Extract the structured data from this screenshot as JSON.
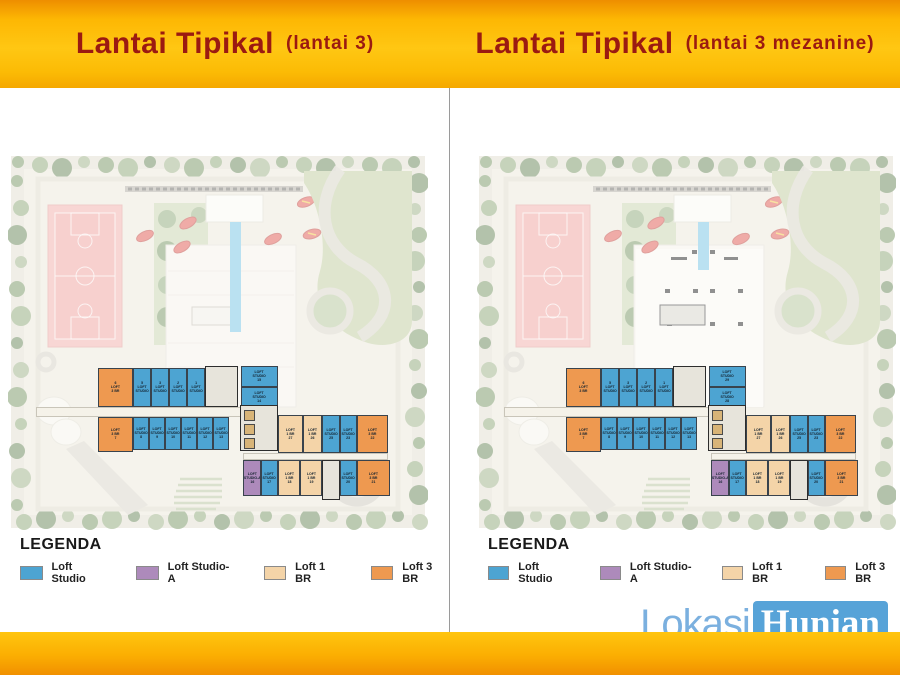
{
  "panels": [
    {
      "id": "lantai-3",
      "title": "Lantai Tipikal",
      "subtitle": "(lantai 3)",
      "mezzanine": false,
      "units": [
        {
          "t": "br3",
          "lines": [
            "6",
            "LOFT",
            "3 BR"
          ],
          "x": 90,
          "y": 215,
          "w": 35,
          "h": 39
        },
        {
          "t": "st",
          "lines": [
            "5",
            "LOFT",
            "STUDIO"
          ],
          "x": 125,
          "y": 215,
          "w": 18,
          "h": 39
        },
        {
          "t": "st",
          "lines": [
            "3",
            "LOFT",
            "STUDIO"
          ],
          "x": 143,
          "y": 215,
          "w": 18,
          "h": 39
        },
        {
          "t": "st",
          "lines": [
            "2",
            "LOFT",
            "STUDIO"
          ],
          "x": 161,
          "y": 215,
          "w": 18,
          "h": 39
        },
        {
          "t": "st",
          "lines": [
            "1",
            "LOFT",
            "STUDIO"
          ],
          "x": 179,
          "y": 215,
          "w": 18,
          "h": 39
        },
        {
          "t": "core",
          "sub": "stair",
          "x": 197,
          "y": 213,
          "w": 33,
          "h": 41
        },
        {
          "t": "st",
          "lines": [
            "LOFT",
            "STUDIO",
            "15"
          ],
          "x": 233,
          "y": 213,
          "w": 37,
          "h": 21
        },
        {
          "t": "st",
          "lines": [
            "LOFT",
            "STUDIO",
            "14"
          ],
          "x": 233,
          "y": 234,
          "w": 37,
          "h": 21
        },
        {
          "t": "cor",
          "x": 28,
          "y": 254,
          "w": 242,
          "h": 10
        },
        {
          "t": "br3",
          "lines": [
            "LOFT",
            "3 BR",
            "7"
          ],
          "x": 90,
          "y": 264,
          "w": 35,
          "h": 35
        },
        {
          "t": "st",
          "lines": [
            "LOFT",
            "STUDIO",
            "8"
          ],
          "x": 125,
          "y": 264,
          "w": 16,
          "h": 33
        },
        {
          "t": "st",
          "lines": [
            "LOFT",
            "STUDIO",
            "9"
          ],
          "x": 141,
          "y": 264,
          "w": 16,
          "h": 33
        },
        {
          "t": "st",
          "lines": [
            "LOFT",
            "STUDIO",
            "10"
          ],
          "x": 157,
          "y": 264,
          "w": 16,
          "h": 33
        },
        {
          "t": "st",
          "lines": [
            "LOFT",
            "STUDIO",
            "11"
          ],
          "x": 173,
          "y": 264,
          "w": 16,
          "h": 33
        },
        {
          "t": "st",
          "lines": [
            "LOFT",
            "STUDIO",
            "12"
          ],
          "x": 189,
          "y": 264,
          "w": 16,
          "h": 33
        },
        {
          "t": "st",
          "lines": [
            "LOFT",
            "STUDIO",
            "13"
          ],
          "x": 205,
          "y": 264,
          "w": 16,
          "h": 33
        },
        {
          "t": "core",
          "sub": "lift",
          "x": 232,
          "y": 252,
          "w": 38,
          "h": 46
        },
        {
          "t": "br1",
          "lines": [
            "LOFT",
            "1 BR",
            "27"
          ],
          "x": 270,
          "y": 262,
          "w": 25,
          "h": 38
        },
        {
          "t": "br1",
          "lines": [
            "LOFT",
            "1 BR",
            "26"
          ],
          "x": 295,
          "y": 262,
          "w": 19,
          "h": 38
        },
        {
          "t": "st",
          "lines": [
            "LOFT",
            "STUDIO",
            "25"
          ],
          "x": 314,
          "y": 262,
          "w": 18,
          "h": 38
        },
        {
          "t": "st",
          "lines": [
            "LOFT",
            "STUDIO",
            "23"
          ],
          "x": 332,
          "y": 262,
          "w": 17,
          "h": 38
        },
        {
          "t": "br3",
          "lines": [
            "LOFT",
            "3 BR",
            "22"
          ],
          "x": 349,
          "y": 262,
          "w": 31,
          "h": 38
        },
        {
          "t": "cor",
          "x": 235,
          "y": 300,
          "w": 145,
          "h": 7
        },
        {
          "t": "stA",
          "lines": [
            "LOFT",
            "STUDIO-A",
            "16"
          ],
          "x": 235,
          "y": 307,
          "w": 18,
          "h": 36
        },
        {
          "t": "st",
          "lines": [
            "LOFT",
            "STUDIO",
            "17"
          ],
          "x": 253,
          "y": 307,
          "w": 17,
          "h": 36
        },
        {
          "t": "br1",
          "lines": [
            "LOFT",
            "1 BR",
            "18"
          ],
          "x": 270,
          "y": 307,
          "w": 22,
          "h": 36
        },
        {
          "t": "br1",
          "lines": [
            "LOFT",
            "1 BR",
            "19"
          ],
          "x": 292,
          "y": 307,
          "w": 22,
          "h": 36
        },
        {
          "t": "core",
          "sub": "stair",
          "x": 314,
          "y": 307,
          "w": 18,
          "h": 40
        },
        {
          "t": "st",
          "lines": [
            "LOFT",
            "STUDIO",
            "20"
          ],
          "x": 332,
          "y": 307,
          "w": 17,
          "h": 36
        },
        {
          "t": "br3",
          "lines": [
            "LOFT",
            "3 BR",
            "21"
          ],
          "x": 349,
          "y": 307,
          "w": 33,
          "h": 36
        }
      ]
    },
    {
      "id": "lantai-3-mezanine",
      "title": "Lantai Tipikal",
      "subtitle": "(lantai 3 mezanine)",
      "mezzanine": true,
      "units": [
        {
          "t": "br3",
          "lines": [
            "6",
            "LOFT",
            "3 BR"
          ],
          "x": 90,
          "y": 215,
          "w": 35,
          "h": 39
        },
        {
          "t": "st",
          "lines": [
            "5",
            "LOFT",
            "STUDIO"
          ],
          "x": 125,
          "y": 215,
          "w": 18,
          "h": 39
        },
        {
          "t": "st",
          "lines": [
            "3",
            "LOFT",
            "STUDIO"
          ],
          "x": 143,
          "y": 215,
          "w": 18,
          "h": 39
        },
        {
          "t": "st",
          "lines": [
            "2",
            "LOFT",
            "STUDIO"
          ],
          "x": 161,
          "y": 215,
          "w": 18,
          "h": 39
        },
        {
          "t": "st",
          "lines": [
            "1",
            "LOFT",
            "STUDIO"
          ],
          "x": 179,
          "y": 215,
          "w": 18,
          "h": 39
        },
        {
          "t": "core",
          "sub": "stair",
          "x": 197,
          "y": 213,
          "w": 33,
          "h": 41
        },
        {
          "t": "st",
          "lines": [
            "LOFT",
            "STUDIO",
            "29"
          ],
          "x": 233,
          "y": 213,
          "w": 37,
          "h": 21
        },
        {
          "t": "st",
          "lines": [
            "LOFT",
            "STUDIO",
            "28"
          ],
          "x": 233,
          "y": 234,
          "w": 37,
          "h": 21
        },
        {
          "t": "cor",
          "x": 28,
          "y": 254,
          "w": 242,
          "h": 10
        },
        {
          "t": "br3",
          "lines": [
            "LOFT",
            "3 BR",
            "7"
          ],
          "x": 90,
          "y": 264,
          "w": 35,
          "h": 35
        },
        {
          "t": "st",
          "lines": [
            "LOFT",
            "STUDIO",
            "8"
          ],
          "x": 125,
          "y": 264,
          "w": 16,
          "h": 33
        },
        {
          "t": "st",
          "lines": [
            "LOFT",
            "STUDIO",
            "9"
          ],
          "x": 141,
          "y": 264,
          "w": 16,
          "h": 33
        },
        {
          "t": "st",
          "lines": [
            "LOFT",
            "STUDIO",
            "10"
          ],
          "x": 157,
          "y": 264,
          "w": 16,
          "h": 33
        },
        {
          "t": "st",
          "lines": [
            "LOFT",
            "STUDIO",
            "11"
          ],
          "x": 173,
          "y": 264,
          "w": 16,
          "h": 33
        },
        {
          "t": "st",
          "lines": [
            "LOFT",
            "STUDIO",
            "12"
          ],
          "x": 189,
          "y": 264,
          "w": 16,
          "h": 33
        },
        {
          "t": "st",
          "lines": [
            "LOFT",
            "STUDIO",
            "13"
          ],
          "x": 205,
          "y": 264,
          "w": 16,
          "h": 33
        },
        {
          "t": "core",
          "sub": "lift",
          "x": 232,
          "y": 252,
          "w": 38,
          "h": 46
        },
        {
          "t": "br1",
          "lines": [
            "LOFT",
            "1 BR",
            "27"
          ],
          "x": 270,
          "y": 262,
          "w": 25,
          "h": 38
        },
        {
          "t": "br1",
          "lines": [
            "LOFT",
            "1 BR",
            "26"
          ],
          "x": 295,
          "y": 262,
          "w": 19,
          "h": 38
        },
        {
          "t": "st",
          "lines": [
            "LOFT",
            "STUDIO",
            "25"
          ],
          "x": 314,
          "y": 262,
          "w": 18,
          "h": 38
        },
        {
          "t": "st",
          "lines": [
            "LOFT",
            "STUDIO",
            "23"
          ],
          "x": 332,
          "y": 262,
          "w": 17,
          "h": 38
        },
        {
          "t": "br3",
          "lines": [
            "LOFT",
            "3 BR",
            "22"
          ],
          "x": 349,
          "y": 262,
          "w": 31,
          "h": 38
        },
        {
          "t": "cor",
          "x": 235,
          "y": 300,
          "w": 145,
          "h": 7
        },
        {
          "t": "stA",
          "lines": [
            "LOFT",
            "STUDIO-A",
            "16"
          ],
          "x": 235,
          "y": 307,
          "w": 18,
          "h": 36
        },
        {
          "t": "st",
          "lines": [
            "LOFT",
            "STUDIO",
            "17"
          ],
          "x": 253,
          "y": 307,
          "w": 17,
          "h": 36
        },
        {
          "t": "br1",
          "lines": [
            "LOFT",
            "1 BR",
            "18"
          ],
          "x": 270,
          "y": 307,
          "w": 22,
          "h": 36
        },
        {
          "t": "br1",
          "lines": [
            "LOFT",
            "1 BR",
            "19"
          ],
          "x": 292,
          "y": 307,
          "w": 22,
          "h": 36
        },
        {
          "t": "core",
          "sub": "stair",
          "x": 314,
          "y": 307,
          "w": 18,
          "h": 40
        },
        {
          "t": "st",
          "lines": [
            "LOFT",
            "STUDIO",
            "20"
          ],
          "x": 332,
          "y": 307,
          "w": 17,
          "h": 36
        },
        {
          "t": "br3",
          "lines": [
            "LOFT",
            "3 BR",
            "21"
          ],
          "x": 349,
          "y": 307,
          "w": 33,
          "h": 36
        }
      ]
    }
  ],
  "legend": {
    "heading": "LEGENDA",
    "items": [
      {
        "key": "st",
        "label": "Loft Studio"
      },
      {
        "key": "stA",
        "label": "Loft Studio-A"
      },
      {
        "key": "br1",
        "label": "Loft 1 BR"
      },
      {
        "key": "br3",
        "label": "Loft 3 BR"
      }
    ]
  },
  "watermark": {
    "part1": "Lokasi",
    "part2": "Hunian"
  },
  "colors": {
    "st": "#4DA4D2",
    "stA": "#AD8ABB",
    "br1": "#F4D4A8",
    "br3": "#EE9950",
    "core": "#E7E4DB",
    "cor": "#F5F2E9",
    "header_text": "#9B1A11",
    "header_bar": "#FFC713",
    "footer_bar": "#FBAE02",
    "watermark_badge": "#57A3D8",
    "watermark_text": "#7BB0DF",
    "pool": "#7CC6E6",
    "court": "#F2B2AE"
  }
}
